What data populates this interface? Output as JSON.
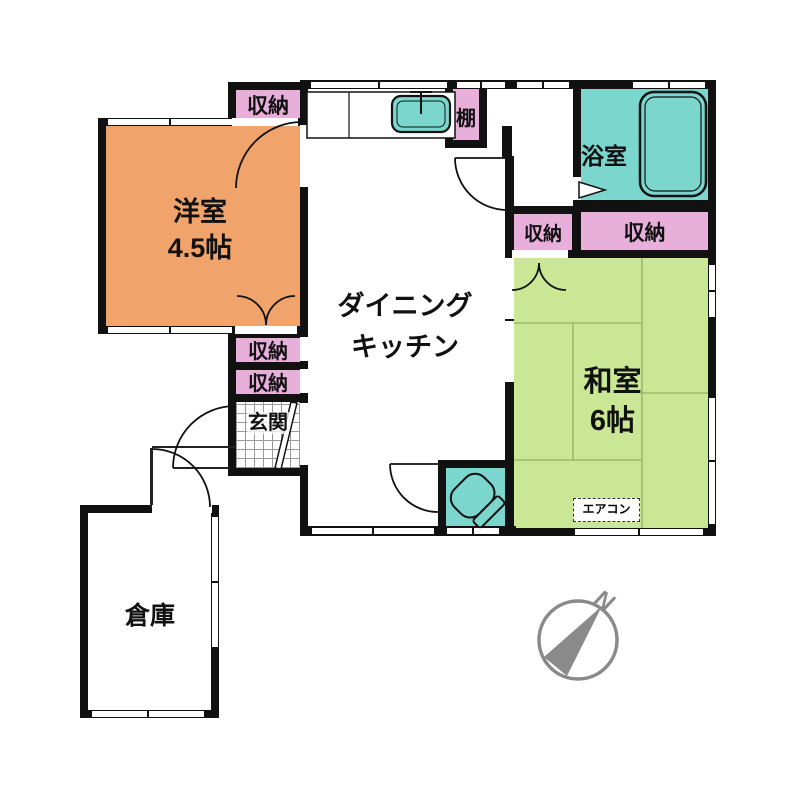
{
  "rooms": {
    "western_room": {
      "name": "洋室",
      "size": "4.5帖"
    },
    "dining_kitchen": {
      "name_line1": "ダイニング",
      "name_line2": "キッチン"
    },
    "bathroom": {
      "name": "浴室"
    },
    "japanese_room": {
      "name": "和室",
      "size": "6帖"
    },
    "warehouse": {
      "name": "倉庫"
    },
    "entrance": {
      "name": "玄関"
    }
  },
  "closets": [
    {
      "label": "収納"
    },
    {
      "label": "収納"
    },
    {
      "label": "収納"
    },
    {
      "label": "収納"
    },
    {
      "label": "収納"
    }
  ],
  "fixtures": {
    "shelf_label": "棚",
    "aircon_label": "エアコン",
    "compass_north_label": "N"
  },
  "colors": {
    "western_room_orange": "#F0A36B",
    "japanese_room_green": "#C9E795",
    "water_area_teal": "#7BD6CE",
    "closet_pink": "#E7AFDA",
    "wall_black": "#111111",
    "compass_gray": "#8A8A8A",
    "tatami_line_green": "#9CBA67"
  }
}
